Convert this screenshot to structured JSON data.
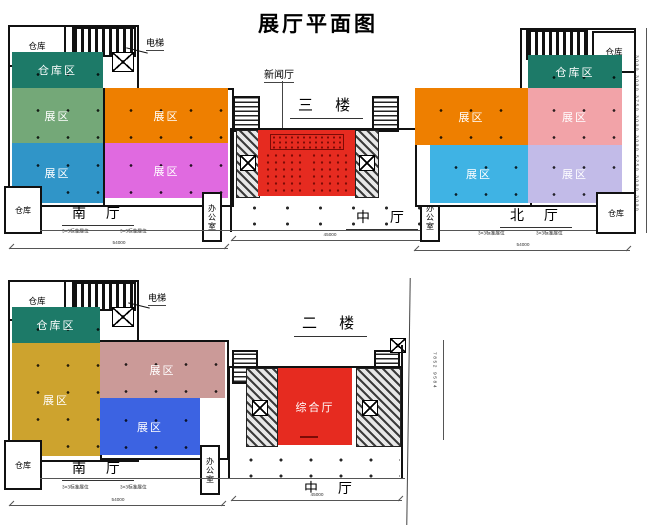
{
  "title": "展厅平面图",
  "colors": {
    "teal": "#1d7a68",
    "green": "#74a878",
    "orange": "#ee7f00",
    "blue_top": "#3095c8",
    "magenta": "#e06ae0",
    "salmon": "#f2a3a8",
    "cyan": "#3fb3e4",
    "lavender": "#c2bbe8",
    "red": "#e62b20",
    "gold": "#cda32e",
    "rose": "#cb9a98",
    "blue_bottom": "#3c63e2"
  },
  "floor3": {
    "floor_label": "三 楼",
    "news_hall_label": "新闻厅",
    "elevator_label": "电梯",
    "south": {
      "warehouse_top": "仓库",
      "warehouse_area": "仓库区",
      "zone_green": "展区",
      "zone_orange": "展区",
      "zone_blue": "展区",
      "zone_magenta": "展区",
      "warehouse_bottom": "仓库",
      "office": "办公室",
      "hall": "南 厅",
      "booth_left": "3×3标准展位",
      "booth_right": "3×3标准展位",
      "dim": "54000"
    },
    "center": {
      "hall": "中 厅",
      "office_right": "办公室",
      "dim": "45000"
    },
    "north": {
      "warehouse_top": "仓库",
      "warehouse_area": "仓库区",
      "zone_orange": "展区",
      "zone_salmon": "展区",
      "zone_cyan": "展区",
      "zone_lavender": "展区",
      "warehouse_bottom": "仓库",
      "hall": "北 厅",
      "booth_left": "3×3标准展位",
      "booth_right": "3×3标准展位",
      "dim": "54000"
    },
    "right_dims": "3000 3000 3750 3000 3000 5250 3000 3000"
  },
  "floor2": {
    "floor_label": "二 楼",
    "elevator_label": "电梯",
    "main_hall_label": "综合厅",
    "south": {
      "warehouse_top": "仓库",
      "warehouse_area": "仓库区",
      "zone_gold": "展区",
      "zone_rose": "展区",
      "zone_blue": "展区",
      "warehouse_bottom": "仓库",
      "office": "办公室",
      "hall": "南 厅",
      "booth_left": "3×3标准展位",
      "booth_right": "3×3标准展位",
      "dim": "54000"
    },
    "center": {
      "hall": "中 厅",
      "dim": "45000"
    },
    "side_dims": "7852 9584"
  }
}
